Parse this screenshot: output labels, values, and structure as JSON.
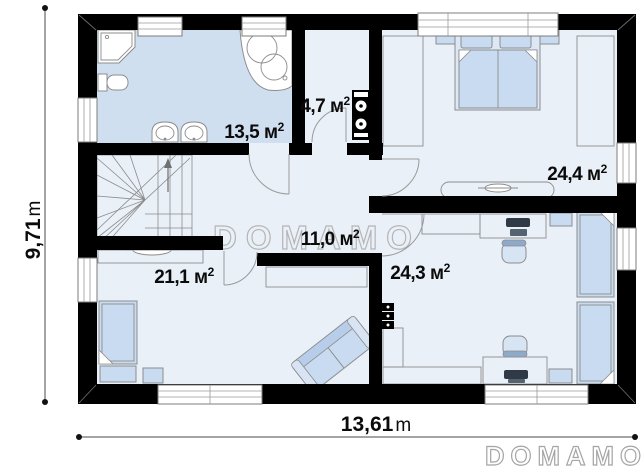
{
  "page": {
    "background": "#ffffff"
  },
  "watermark": {
    "center_text": "DOMAMO",
    "brand_text": "DOMAMO"
  },
  "dimensions": {
    "height": {
      "value": "9,71",
      "unit": "m"
    },
    "width": {
      "value": "13,61",
      "unit": "m"
    }
  },
  "rooms": {
    "bathroom": {
      "label": "13,5 м",
      "sup": "2"
    },
    "utility": {
      "label": "4,7 м",
      "sup": "2"
    },
    "bedroom1": {
      "label": "24,4 м",
      "sup": "2"
    },
    "hall": {
      "label": "11,0 м",
      "sup": "2"
    },
    "bedroom2": {
      "label": "21,1 м",
      "sup": "2"
    },
    "bedroom3": {
      "label": "24,3 м",
      "sup": "2"
    }
  },
  "colors": {
    "wall": "#000000",
    "floor": "#eaf0f8",
    "bathroom_floor": "#cfdff0",
    "furniture": "#c9dbf0",
    "outline": "#8c8c8c",
    "watermark": "#b5b5b5"
  }
}
